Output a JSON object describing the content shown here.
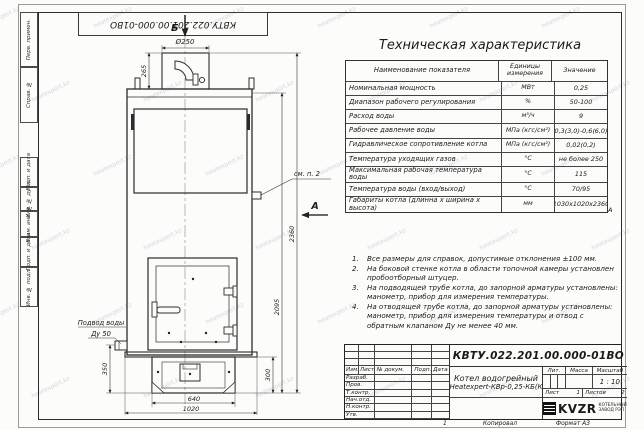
{
  "sheet": {
    "doc_number": "КВТУ.022.201.00.000-01ВО",
    "copied_label": "Копировал",
    "format_label": "Формат А3",
    "zone_letter": "А",
    "zone_number": "1",
    "margin_labels": [
      "Перв. примен.",
      "Справ. №",
      "Подп. и дата",
      "Инв. № дубл.",
      "Взам. инв. №",
      "Подп. и дата",
      "Инв. № подл."
    ]
  },
  "drawing": {
    "section_label_b": "Б",
    "view_label_a": "А",
    "see_note_label": "см. п. 2",
    "water_inlet_line1": "Подвод воды",
    "water_inlet_line2": "Ду 50",
    "dims": {
      "chimney_diameter": "Ø250",
      "chimney_height": "265",
      "body_height": "2095",
      "total_height": "2360",
      "inlet_height": "350",
      "base_height": "300",
      "base_width": "640",
      "overall_width": "1020"
    }
  },
  "spec_table": {
    "title": "Техническая характеристика",
    "headers": [
      "Наименование показателя",
      "Единицы измерения",
      "Значение"
    ],
    "rows": [
      [
        "Номинальная мощность",
        "МВт",
        "0,25"
      ],
      [
        "Диапазон рабочего регулирования",
        "%",
        "50-100"
      ],
      [
        "Расход воды",
        "м³/ч",
        "9"
      ],
      [
        "Рабочее давление воды",
        "МПа (кгс/см²)",
        "0,3(3,0)-0,6(6,0)"
      ],
      [
        "Гидравлическое сопротивление котла",
        "МПа (кгс/см²)",
        "0,02(0,2)"
      ],
      [
        "Температура уходящих газов",
        "°С",
        "не более 250"
      ],
      [
        "Максимальная рабочая температура воды",
        "°С",
        "115"
      ],
      [
        "Температура воды (вход/выход)",
        "°С",
        "70/95"
      ],
      [
        "Габариты котла (длинна х ширина х высота)",
        "мм",
        "1030х1020х2360"
      ]
    ]
  },
  "notes": [
    "Все размеры для справок, допустимые отклонения ±100 мм.",
    "На боковой стенке котла в области топочной камеры установлен пробоотборный штуцер.",
    "На подводящей трубе котла, до запорной арматуры установлены: манометр, прибор для измерения температуры.",
    "На отводящей трубе котла, до запорной арматуры установлены: манометр, прибор для измерения температуры и отвод с обратным клапаном Ду не менее 40 мм."
  ],
  "title_block": {
    "doc_number": "КВТУ.022.201.00.000-01ВО",
    "product_name_line1": "Котел водогрейный",
    "product_name_line2": "Heatexpert-КВр-0,25-КБ(К",
    "header_cols": [
      "Изм.",
      "Лист",
      "№ докум.",
      "Подп.",
      "Дата"
    ],
    "row_labels": [
      "Разраб.",
      "Пров.",
      "Т.контр.",
      "Нач.отд.",
      "Н.контр.",
      "Утв."
    ],
    "lit_label": "Лит.",
    "mass_label": "Масса",
    "scale_label": "Масштаб",
    "scale_value": "1 : 10",
    "sheet_label": "Лист",
    "sheet_value": "1",
    "sheets_label": "Листов",
    "sheets_value": "2",
    "logo_text": "KVZR",
    "logo_sub_line1": "КОТЕЛЬНЫЙ",
    "logo_sub_line2": "ЗАВОД РЭП"
  },
  "watermark": {
    "text": "heatexpert.kz"
  }
}
